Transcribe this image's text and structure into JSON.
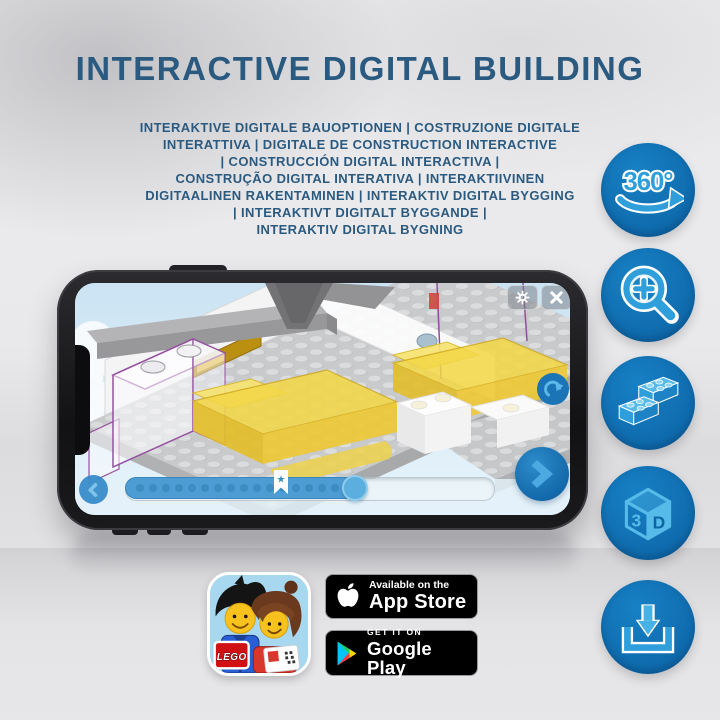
{
  "title": "INTERACTIVE DIGITAL BUILDING",
  "subtitle_lines": [
    "INTERAKTIVE DIGITALE BAUOPTIONEN | COSTRUZIONE DIGITALE",
    "INTERATTIVA | DIGITALE DE CONSTRUCTION INTERACTIVE",
    "| CONSTRUCCIÓN DIGITAL INTERACTIVA |",
    "CONSTRUÇÃO DIGITAL INTERATIVA | INTERAKTIIVINEN",
    "DIGITAALINEN RAKENTAMINEN | INTERAKTIV DIGITAL BYGGING",
    "| INTERAKTIVT DIGITALT BYGGANDE |",
    "INTERAKTIV DIGITAL BYGNING"
  ],
  "feature_icons": {
    "rotation_label": "360°",
    "cube_3": "3",
    "cube_d": "D",
    "names": [
      "360-rotation-icon",
      "zoom-icon",
      "lego-bricks-icon",
      "3d-view-icon",
      "download-icon"
    ]
  },
  "phone_app": {
    "icons": [
      "gear-icon",
      "close-icon",
      "rotate-icon",
      "back-icon",
      "next-icon",
      "bookmark-star-icon"
    ]
  },
  "store": {
    "app_store": {
      "tagline": "Available on the",
      "name": "App Store"
    },
    "google_play": {
      "tagline": "GET IT ON",
      "name": "Google Play"
    },
    "lego_logo": "LEGO"
  },
  "colors": {
    "title_blue": "#2b5a80",
    "feature_circle_blue": "#0f6cae",
    "icon_light_blue": "#3aabe2",
    "progress_blue": "#4d9dd4",
    "lego_yellow": "#f3d747",
    "badge_black": "#000000"
  }
}
